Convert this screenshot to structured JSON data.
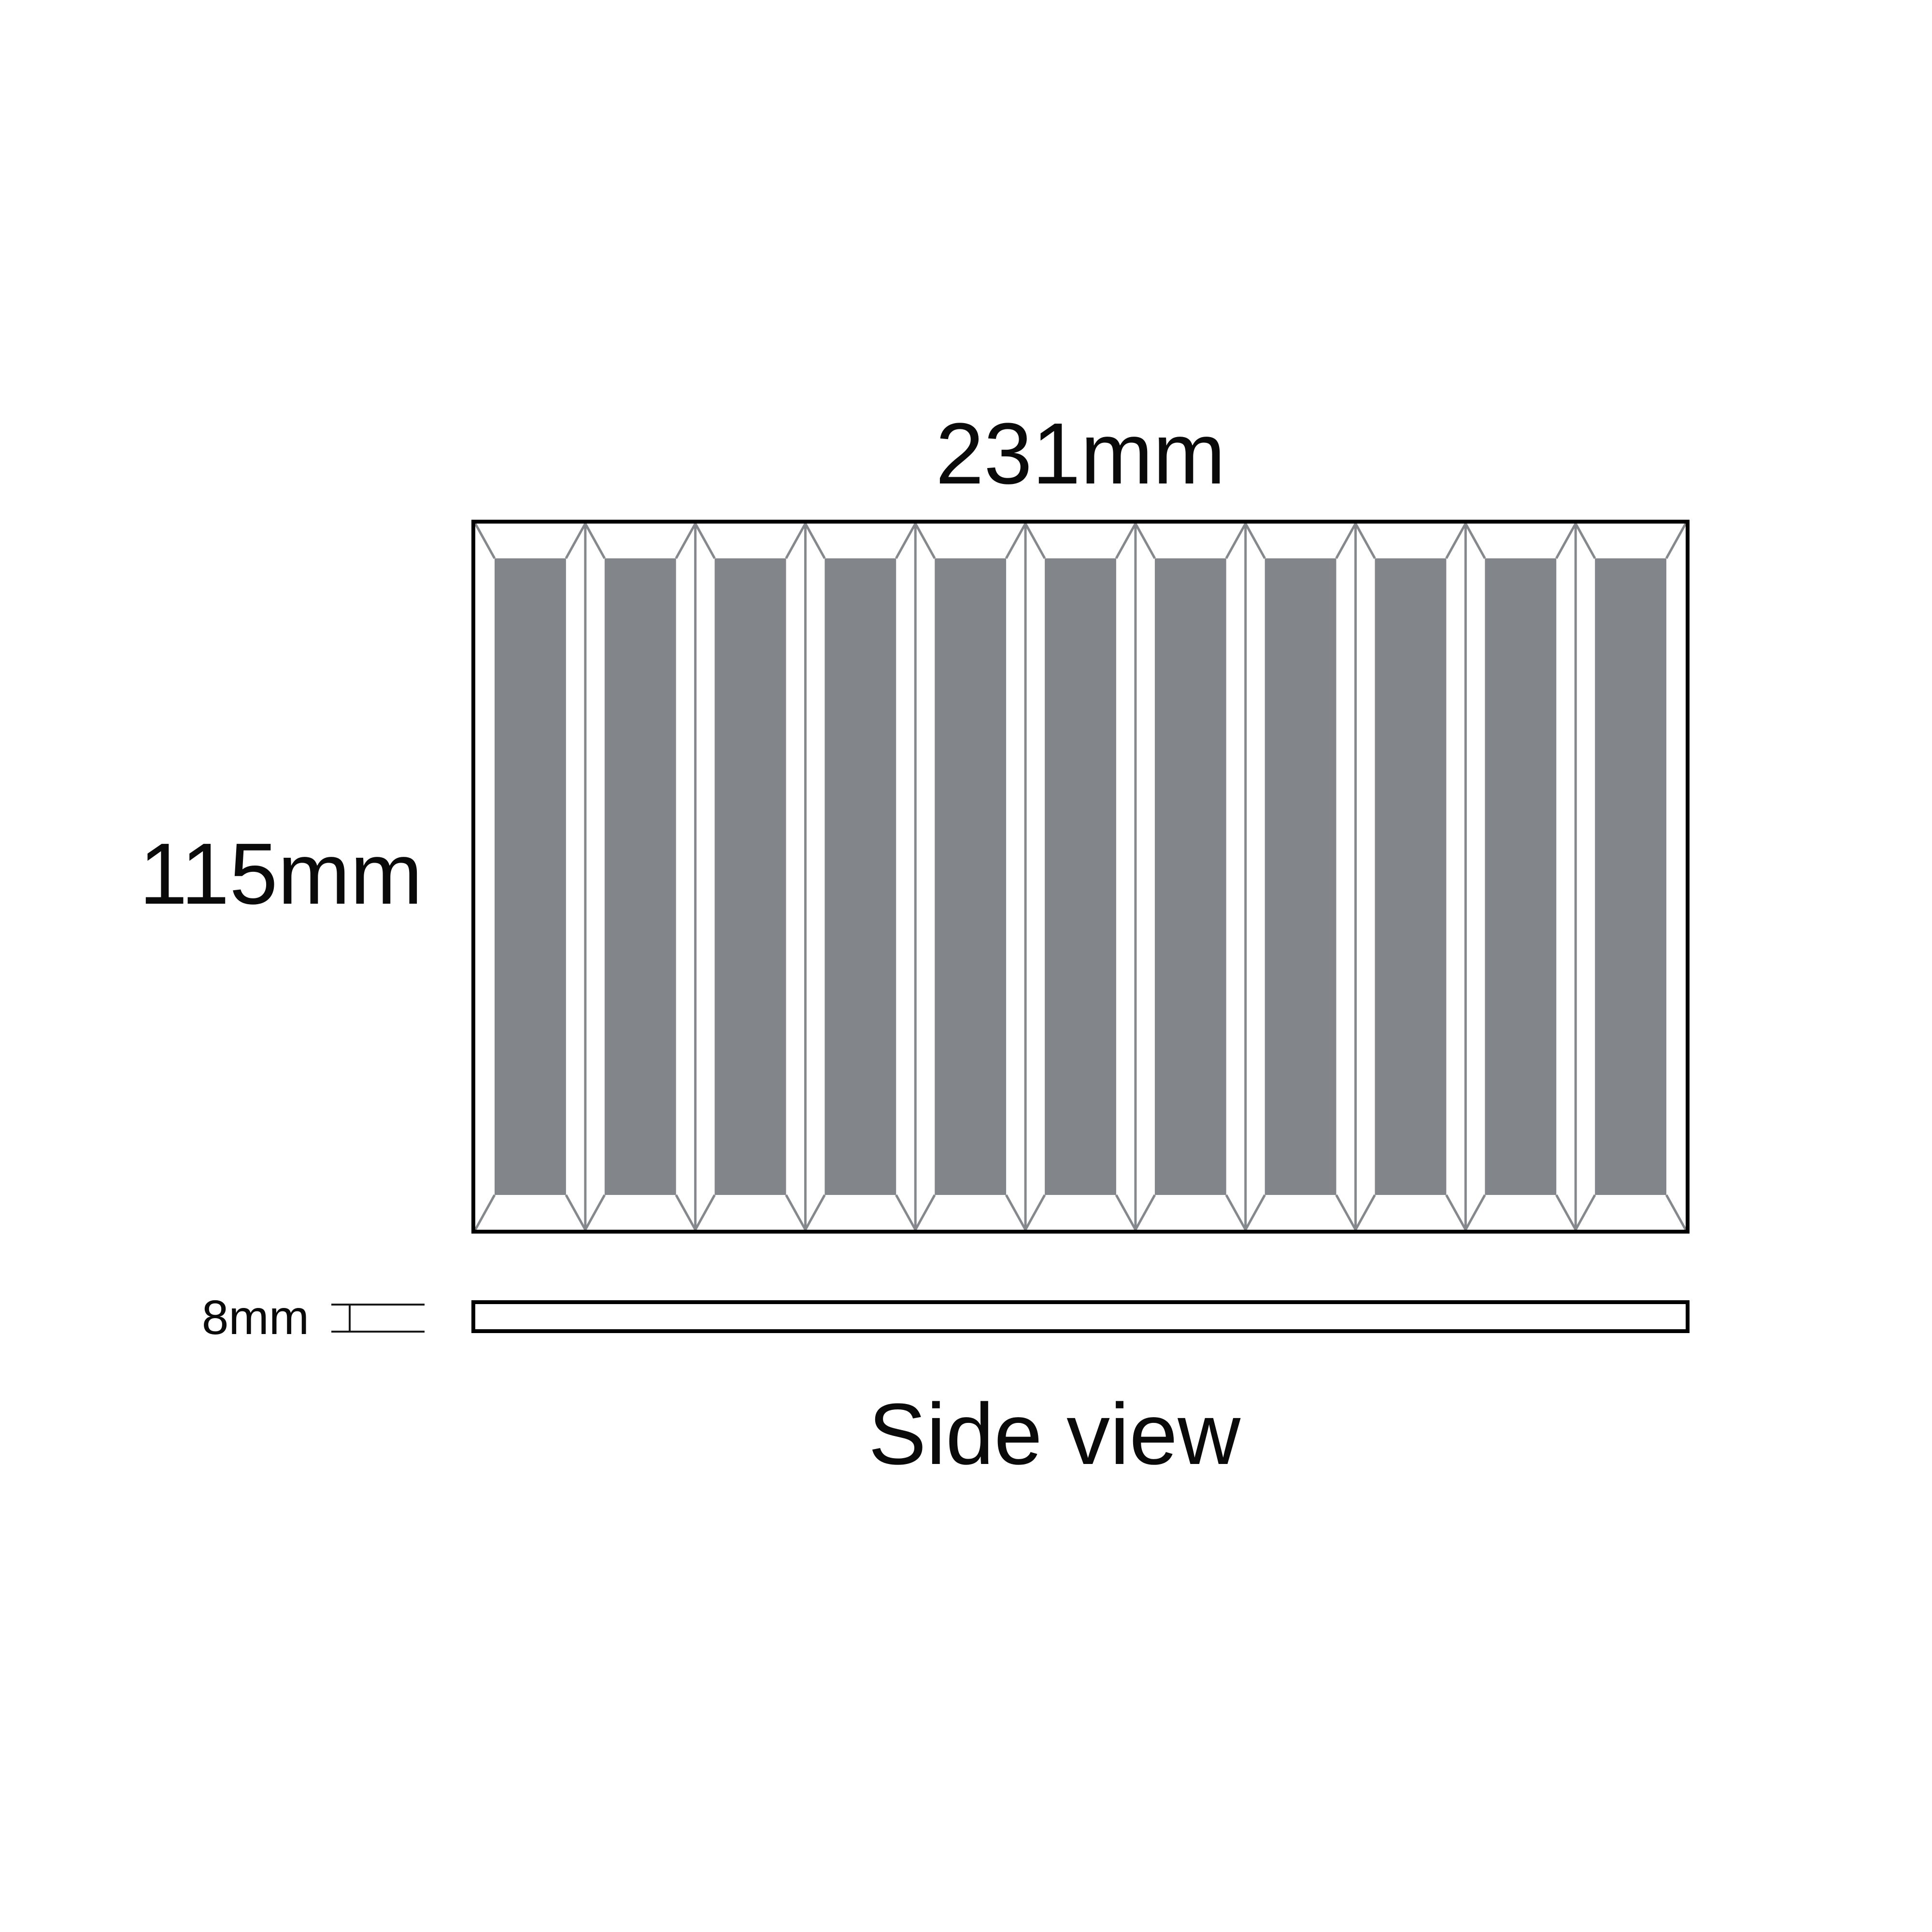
{
  "front_view": {
    "width_label": "231mm",
    "height_label": "115mm",
    "flute_count": 11
  },
  "side_view": {
    "thickness_label": "8mm",
    "caption": "Side view"
  },
  "colors": {
    "flute_fill": "#828589",
    "line_gray": "#85888c",
    "outline": "#000000"
  }
}
